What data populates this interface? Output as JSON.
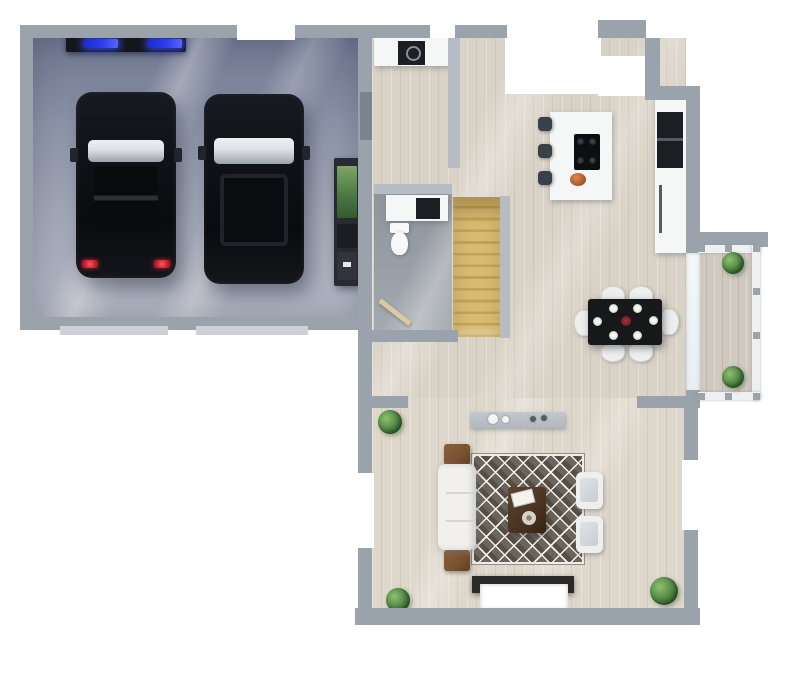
{
  "meta": {
    "title": "3D Floor Plan — Ground Floor (Top-Down Render)",
    "render_style": "photorealistic top view, no text labels"
  },
  "palette": {
    "background": "#ffffff",
    "wall": "#9aa3ac",
    "wallLight": "#b5bcc3",
    "wallDark": "#7b848e",
    "garageFloorTop": "#6e7690",
    "garageFloorBottom": "#b2b6c2",
    "woodFloor": "#d9d2c6",
    "livingFloor": "#ded7cb",
    "wcFloor": "#9aa0a8",
    "stairTread": "#d8bb70",
    "stairRiser": "#c1a257",
    "rugBase": "#6b655d",
    "rugLattice": "#f3f1ec",
    "carBody": "#0f1116",
    "carGlass": "#dde1e6",
    "tailLight": "#c22430",
    "garageDoorBar": "#14171d",
    "garageDoorGlow": "#2b3bf0",
    "counter": "#f5f6f6",
    "appliance": "#1b1e23",
    "islandStool": "#3a4048",
    "diningTable": "#17181a",
    "plate": "#f6f6f4",
    "chair": "#eeefee",
    "sofa": "#f1f0ed",
    "cushion": "#c9cdd2",
    "sideTable": "#7a5131",
    "coffeeTable": "#4a3322",
    "consoleGray": "#b3b8bf",
    "fireplaceFrame": "#2b2a28",
    "fireplaceInner": "#ffffff",
    "plant": "#4d8140",
    "plantDark": "#2f5f2c",
    "railing": "#eef0f2",
    "balconyFloor": "#cfc9bf",
    "threshold": "#cdd1d7",
    "decorBowl": "#b0592f"
  },
  "rooms": [
    {
      "id": "garage",
      "label": "Garage"
    },
    {
      "id": "utility",
      "label": "Utility Room"
    },
    {
      "id": "wc",
      "label": "WC / Bathroom"
    },
    {
      "id": "staircase",
      "label": "Staircase"
    },
    {
      "id": "kitchen",
      "label": "Kitchen"
    },
    {
      "id": "dining",
      "label": "Dining Area"
    },
    {
      "id": "living",
      "label": "Living Room"
    },
    {
      "id": "balcony",
      "label": "Balcony / Terrace"
    }
  ],
  "objects": {
    "garage": [
      "black car left",
      "black car right",
      "garage door bar with two blue lights",
      "storage shelf",
      "two door thresholds"
    ],
    "utility": [
      "white counter",
      "black washer"
    ],
    "wc": [
      "white vanity with black sink",
      "toilet",
      "door leaf"
    ],
    "staircase": [
      "12 wooden treads"
    ],
    "kitchen": [
      "white island with black cooktop",
      "three dark bar stools",
      "orange bowl",
      "right wall counter",
      "black oven stack"
    ],
    "dining": [
      "black table",
      "six white chairs",
      "six white plates",
      "red centerpiece"
    ],
    "living": [
      "white sofa",
      "two brown side tables",
      "diamond pattern rug",
      "dark coffee table with books and plate",
      "two white armchairs",
      "gray console with vases",
      "fireplace media unit",
      "three plants"
    ],
    "balcony": [
      "white railing with gray posts",
      "two green planters"
    ]
  }
}
